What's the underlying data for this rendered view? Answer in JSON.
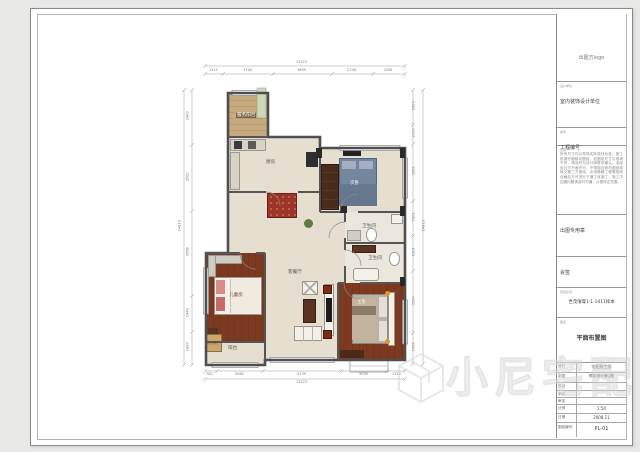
{
  "title_block": {
    "logo_label": "出图方logo",
    "design_unit_label": "设计单位",
    "design_unit": "室内装饰设计单位",
    "project_no_label": "编号",
    "project_no": "工程编号",
    "notes_label": "注意",
    "notes_text": "所有尺寸均以现场实际放线为准，施工前请仔细核对图纸，如图纸尺寸与现场不符，请及时与设计师联系确认。未经设计方书面许可，不得擅自修改图纸或转交第三方使用。水电隐蔽工程需验收合格后方可进行下道工序施工，施工中如遇问题请及时沟通，以便修正完善。",
    "seal_label": "出图专用章",
    "countersign_label": "会签",
    "project_name_label": "项目名称",
    "project_name": "世茂璀璨1-1-1011样本",
    "drawing_name_label": "图名",
    "drawing_name": "平面布置图",
    "table": {
      "rows": [
        {
          "label": "设计",
          "value": "宅配施工图"
        },
        {
          "label": "制图",
          "value": "预算/报价确认图"
        },
        {
          "label": "校对",
          "value": ""
        },
        {
          "label": "审核",
          "value": ""
        },
        {
          "label": "审定",
          "value": ""
        },
        {
          "label": "比例",
          "value": "1:50"
        },
        {
          "label": "日期",
          "value": "2008.11"
        },
        {
          "label": "图纸编号",
          "value": "PL-01"
        }
      ]
    }
  },
  "plan": {
    "rooms": {
      "service_balcony": "服务阳台",
      "kitchen": "厨房",
      "bedroom2": "次卧",
      "bath1": "卫生间",
      "bath2": "卫生间",
      "living": "客餐厅",
      "kids": "儿童房",
      "balcony": "阳台",
      "washer": "洗衣机",
      "master": "主卧"
    },
    "dims": {
      "top": {
        "total": "13223",
        "segments": [
          "1211",
          "3318",
          "3895",
          "2738",
          "2061"
        ]
      },
      "bottom": {
        "total": "13223",
        "segments": [
          "782",
          "3062",
          "5139",
          "3030",
          "1210"
        ]
      },
      "left": {
        "total": "14813",
        "segments": [
          "2943",
          "3562",
          "4568",
          "1940",
          "1800"
        ]
      },
      "right": {
        "total": "14813",
        "segments": [
          "1899",
          "1033",
          "3081",
          "1901",
          "1901",
          "3334",
          "1664"
        ]
      }
    }
  },
  "watermark": {
    "text": "小尼宅配"
  }
}
